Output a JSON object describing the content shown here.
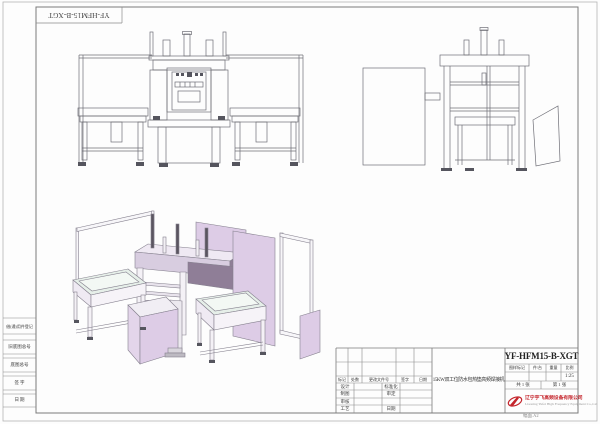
{
  "frame": {
    "top_box_label": "YF-HFM15-B-XGT",
    "left_cells": [
      "借(通)用件登记",
      "旧底图总号",
      "底图总号",
      "签  字",
      "日  期"
    ],
    "bottom_note": "幅面.A2"
  },
  "title_block": {
    "product_name": "15KW双工位防水包热垫高频焊接机",
    "drawing_code": "YF-HFM15-B-XGT",
    "spec_headers": [
      "图样标记",
      "件/台",
      "重量",
      "比例"
    ],
    "spec_values": [
      "",
      "",
      "",
      "1:25"
    ],
    "sheets_total": "共 1 张",
    "sheet_number": "第 1 张",
    "revision_headers": [
      "标记",
      "处数",
      "更改文件号",
      "签字",
      "日期"
    ],
    "sign_labels": [
      [
        "设计",
        "标准化"
      ],
      [
        "制图",
        "审定"
      ],
      [
        "审核",
        ""
      ],
      [
        "工艺",
        "日期"
      ]
    ],
    "company_cn": "辽宁宇飞高频设备有限公司",
    "company_en": "Liaoning Yufei High Frequency Equipment Co.,Ltd"
  },
  "views": {
    "front_view": "front-elevation of dual-station HF welding machine",
    "side_view": "side-elevation with electric cabinet and guard panel",
    "iso_view": "isometric 3D view with lavender panels and two work tables"
  },
  "colors": {
    "line": "#6e6e76",
    "iso_line": "#85808e",
    "panel_lavender": "#ddcce6",
    "panel_lavender_mid": "#cdbad7",
    "panel_mauve_dark": "#8f7e97",
    "top_face": "#efe9f3",
    "table_top": "#e6efe9",
    "company_red": "#c4242b"
  }
}
